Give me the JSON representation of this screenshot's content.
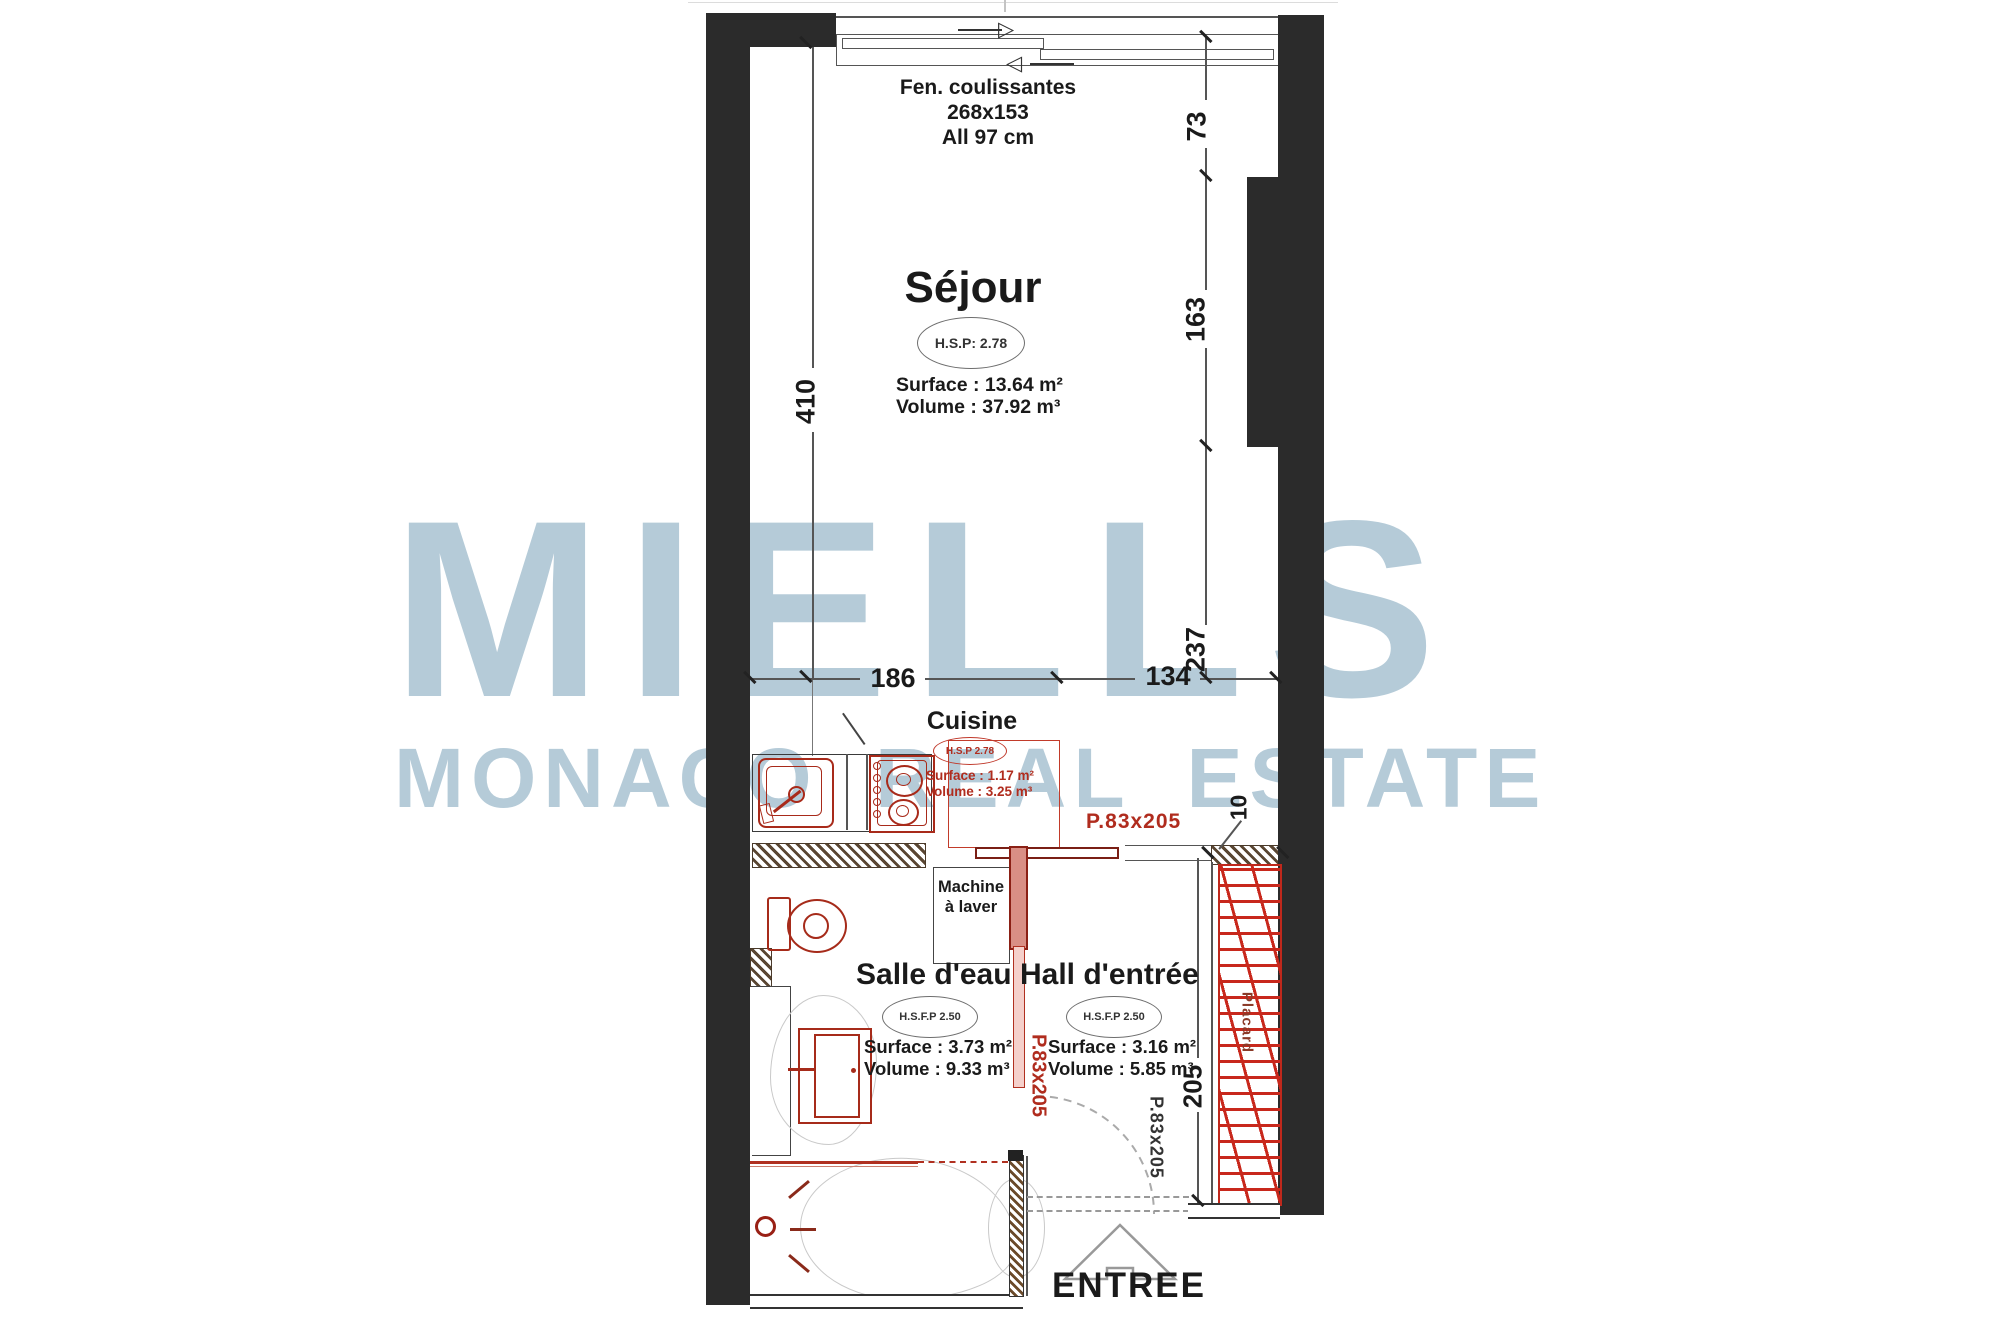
{
  "watermark": {
    "title": "MIELLS",
    "subtitle": "MONACO REAL ESTATE",
    "color": "#b5cbd8"
  },
  "window": {
    "line1": "Fen. coulissantes",
    "line2": "268x153",
    "line3": "All 97 cm"
  },
  "sejour": {
    "name": "Séjour",
    "ceiling_height": "H.S.P: 2.78",
    "surface": "Surface : 13.64 m²",
    "volume": "Volume : 37.92 m³"
  },
  "cuisine": {
    "name": "Cuisine",
    "ceiling_height": "H.S.P 2.78",
    "surface": "Surface : 1.17 m²",
    "volume": "Volume : 3.25 m³",
    "door": "P.83x205"
  },
  "salle_deau": {
    "name": "Salle d'eau",
    "ceiling_height": "H.S.F.P 2.50",
    "surface": "Surface : 3.73 m²",
    "volume": "Volume : 9.33 m³",
    "door": "P.83x205"
  },
  "hall": {
    "name": "Hall d'entrée",
    "ceiling_height": "H.S.F.P 2.50",
    "surface": "Surface : 3.16 m²",
    "volume": "Volume : 5.85 m³",
    "door": "P.83x205"
  },
  "machine_a_laver": {
    "line1": "Machine",
    "line2": "à laver"
  },
  "placard": {
    "name": "Placard"
  },
  "dims": {
    "left_height": "410",
    "right_top": "73",
    "right_mid": "163",
    "right_bottom": "237",
    "width_left": "186",
    "width_right": "134",
    "placard_depth": "10",
    "placard_length": "205"
  },
  "entrance": {
    "label": "ENTREE"
  }
}
